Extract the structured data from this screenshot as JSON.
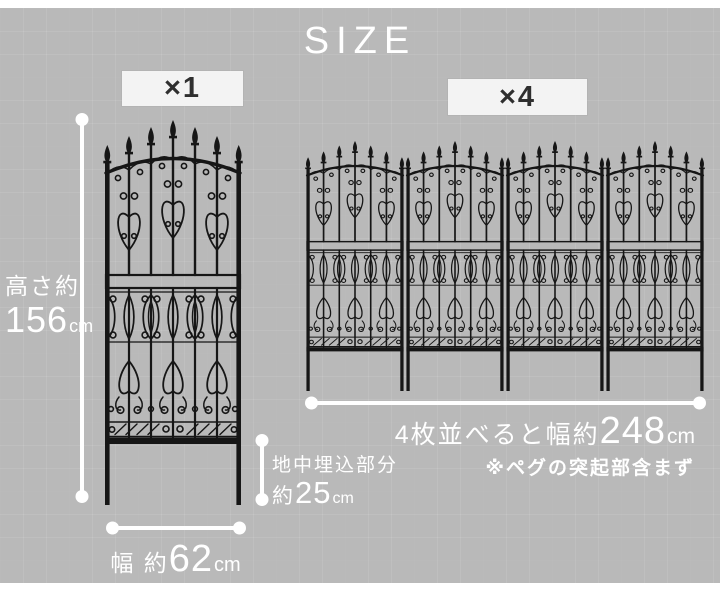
{
  "title": "SIZE",
  "single": {
    "count": "×1",
    "height": {
      "label": "高さ約",
      "value": "156",
      "unit": "cm"
    },
    "buried": {
      "label": "地中埋込部分",
      "prefix": "約",
      "value": "25",
      "unit": "cm"
    },
    "width": {
      "label": "幅 約",
      "value": "62",
      "unit": "cm"
    }
  },
  "multi": {
    "count": "×4",
    "width": {
      "prefix": "4枚並べると幅約",
      "value": "248",
      "unit": "cm"
    },
    "note": "※ペグの突起部含まず"
  },
  "colors": {
    "background": "#b9b9b9",
    "dimension_lines": "#ffffff",
    "fence": "#161616",
    "badge_background": "#f3f3f3",
    "badge_text": "#2f2f2f"
  }
}
